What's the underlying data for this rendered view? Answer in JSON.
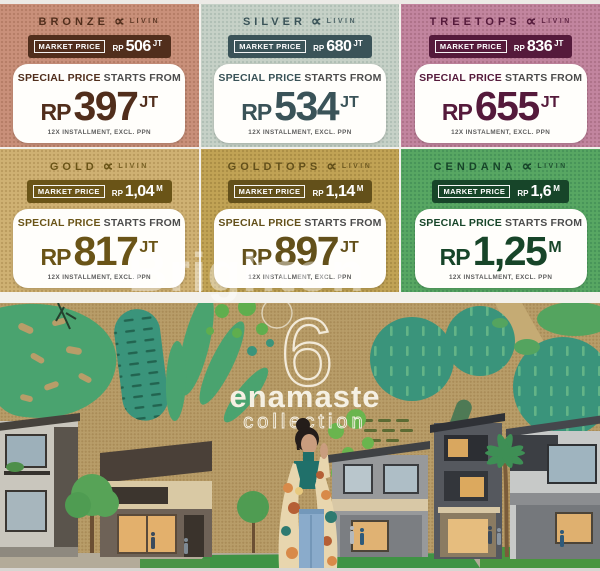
{
  "watermark": "Brighton",
  "special_offer": {
    "bold": "SPECIAL PRICE",
    "rest": "STARTS FROM"
  },
  "cards": [
    {
      "name": "BRONZE",
      "brand_mark": "∝",
      "brand": "LIVIN",
      "market_label": "MARKET PRICE",
      "market_currency": "RP",
      "market_value": "506",
      "market_unit": "JT",
      "special_bold": "SPECIAL PRICE",
      "special_rest": "STARTS FROM",
      "price_currency": "RP",
      "price_value": "397",
      "price_unit": "JT",
      "terms": "12X INSTALLMENT, EXCL. PPN",
      "colors": {
        "bg": "#c9907a",
        "dot": "#b57d66",
        "dark": "#512e1c"
      }
    },
    {
      "name": "SILVER",
      "brand_mark": "∝",
      "brand": "LIVIN",
      "market_label": "MARKET PRICE",
      "market_currency": "RP",
      "market_value": "680",
      "market_unit": "JT",
      "special_bold": "SPECIAL PRICE",
      "special_rest": "STARTS FROM",
      "price_currency": "RP",
      "price_value": "534",
      "price_unit": "JT",
      "terms": "12X INSTALLMENT, EXCL. PPN",
      "colors": {
        "bg": "#c6d1c7",
        "dot": "#b0bfb5",
        "dark": "#3a5358"
      }
    },
    {
      "name": "TREETOPS",
      "brand_mark": "∝",
      "brand": "LIVIN",
      "market_label": "MARKET PRICE",
      "market_currency": "RP",
      "market_value": "836",
      "market_unit": "JT",
      "special_bold": "SPECIAL PRICE",
      "special_rest": "STARTS FROM",
      "price_currency": "RP",
      "price_value": "655",
      "price_unit": "JT",
      "terms": "12X INSTALMENT, EXCL. PPN",
      "colors": {
        "bg": "#c2859f",
        "dot": "#ae7289",
        "dark": "#551a3b"
      }
    },
    {
      "name": "GOLD",
      "brand_mark": "∝",
      "brand": "LIVIN",
      "market_label": "MARKET PRICE",
      "market_currency": "RP",
      "market_value": "1,04",
      "market_unit": "M",
      "special_bold": "SPECIAL PRICE",
      "special_rest": "STARTS FROM",
      "price_currency": "RP",
      "price_value": "817",
      "price_unit": "JT",
      "terms": "12X INSTALLMENT, EXCL. PPN",
      "colors": {
        "bg": "#cfb173",
        "dot": "#ba9b5e",
        "dark": "#6a5417"
      }
    },
    {
      "name": "GOLDTOPS",
      "brand_mark": "∝",
      "brand": "LIVIN",
      "market_label": "MARKET PRICE",
      "market_currency": "RP",
      "market_value": "1,14",
      "market_unit": "M",
      "special_bold": "SPECIAL PRICE",
      "special_rest": "STARTS FROM",
      "price_currency": "RP",
      "price_value": "897",
      "price_unit": "JT",
      "terms": "12X INSTALLMENT, EXCL. PPN",
      "colors": {
        "bg": "#c1a355",
        "dot": "#ab8e45",
        "dark": "#63501a"
      }
    },
    {
      "name": "CENDANA",
      "brand_mark": "∝",
      "brand": "LIVIN",
      "market_label": "MARKET PRICE",
      "market_currency": "RP",
      "market_value": "1,6",
      "market_unit": "M",
      "special_bold": "SPECIAL PRICE",
      "special_rest": "STARTS FROM",
      "price_currency": "RP",
      "price_value": "1,25",
      "price_unit": "M",
      "terms": "12X INSTALLMENT, EXCL. PPN",
      "colors": {
        "bg": "#58a763",
        "dot": "#489459",
        "dark": "#174529"
      }
    }
  ],
  "hero": {
    "number": "6",
    "title": "enamaste",
    "subtitle": "collection",
    "colors": {
      "kraft": "#b89d69",
      "teal": "#3a947b",
      "green": "#54a45f",
      "light_green": "#5fae4e",
      "cream": "#f5f0e3"
    }
  }
}
